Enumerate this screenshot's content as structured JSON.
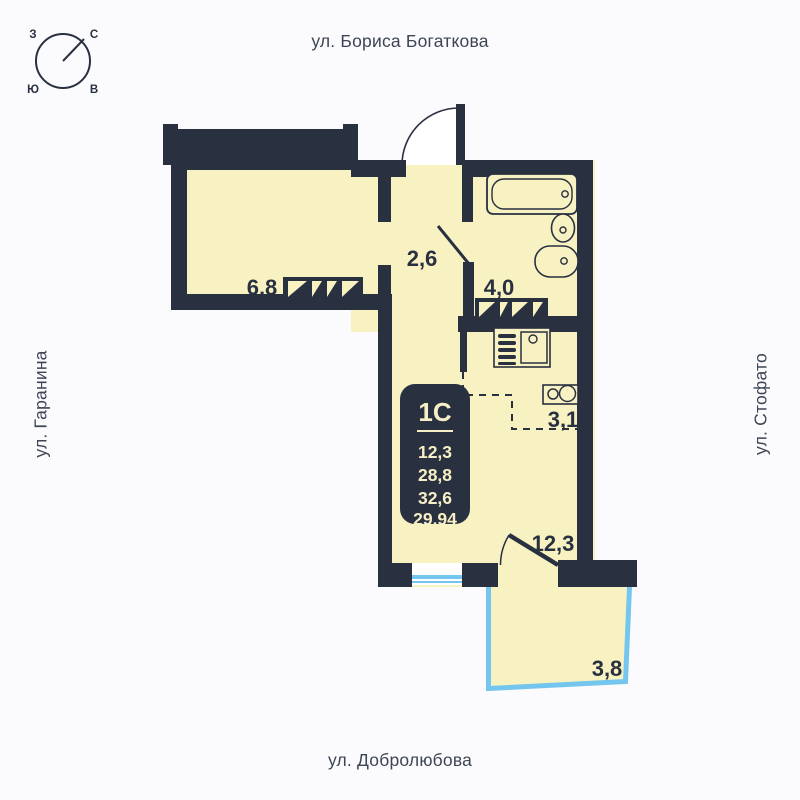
{
  "streets": {
    "top": "ул. Бориса Богаткова",
    "left": "ул. Гаранина",
    "right": "ул. Стофато",
    "bottom": "ул. Добролюбова"
  },
  "compass": {
    "west": "З",
    "north": "С",
    "south": "Ю",
    "east": "В"
  },
  "info_card": {
    "type_label": "1С",
    "values": [
      "12,3",
      "28,8",
      "32,6",
      "29,94"
    ]
  },
  "rooms": {
    "room_68": "6,8",
    "hall": "2,6",
    "bathroom": "4,0",
    "kitchen": "3,1",
    "living": "12,3",
    "balcony": "3,8"
  },
  "colors": {
    "wall": "#293040",
    "room_fill": "#f8f2c2",
    "balcony_accent": "#74c6ee",
    "street_text": "#3d4555",
    "card_text": "#f6efc5",
    "background": "#fbfbfd"
  }
}
